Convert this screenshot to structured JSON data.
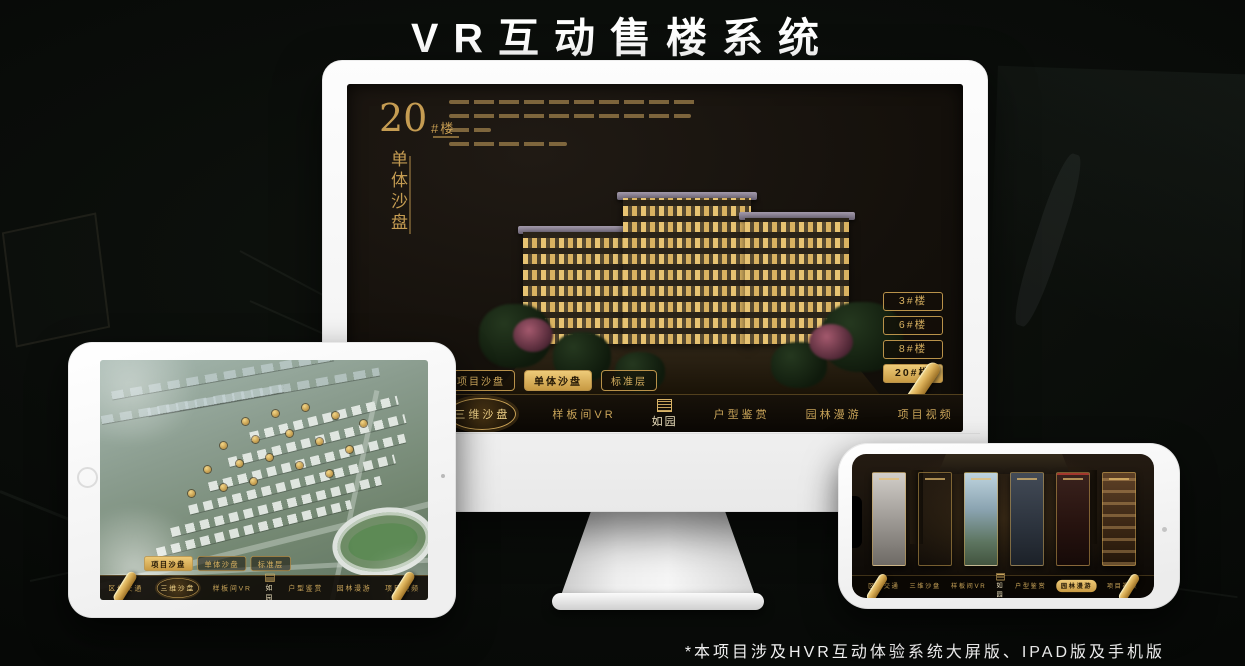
{
  "page": {
    "title": "VR互动售楼系统",
    "footnote": "*本项目涉及HVR互动体验系统大屏版、IPAD版及手机版"
  },
  "colors": {
    "accent_gold": "#d4a651",
    "accent_gold_bright": "#eecb79",
    "screen_background": "#14100b"
  },
  "nav": {
    "items": [
      "区位交通",
      "三维沙盘",
      "样板间VR",
      "户型鉴赏",
      "园林漫游",
      "项目视频"
    ],
    "logo": "如园"
  },
  "monitor": {
    "heading": {
      "number": "20",
      "suffix": "#楼",
      "vertical_label": "单体沙盘"
    },
    "sub_tabs": [
      {
        "label": "项目沙盘",
        "active": false
      },
      {
        "label": "单体沙盘",
        "active": true
      },
      {
        "label": "标准层",
        "active": false
      }
    ],
    "floor_buttons": [
      {
        "label": "3#楼",
        "active": false
      },
      {
        "label": "6#楼",
        "active": false
      },
      {
        "label": "8#楼",
        "active": false
      },
      {
        "label": "20#楼",
        "active": true
      }
    ],
    "active_nav_item": "三维沙盘"
  },
  "tablet": {
    "sub_tabs": [
      {
        "label": "项目沙盘",
        "active": true
      },
      {
        "label": "单体沙盘",
        "active": false
      },
      {
        "label": "标准层",
        "active": false
      }
    ],
    "active_nav_item": "三维沙盘"
  },
  "phone": {
    "active_nav_item": "园林漫游"
  }
}
